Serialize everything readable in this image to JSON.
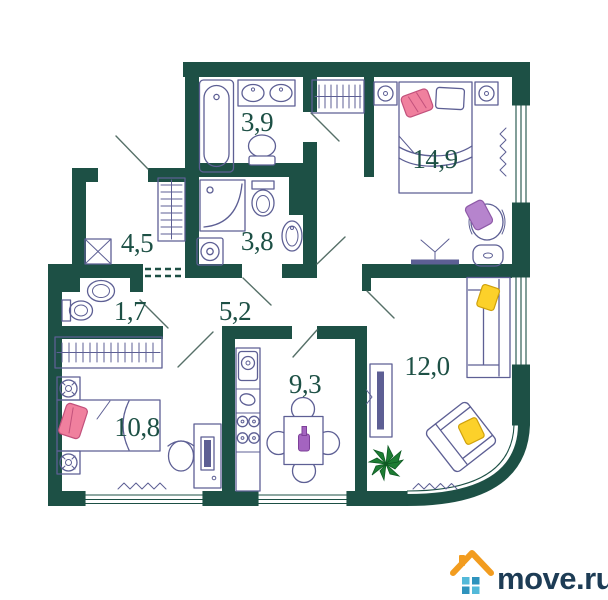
{
  "page": {
    "background": "#ffffff"
  },
  "floor_plan": {
    "rooms": [
      {
        "name": "bathroom-top",
        "area": "3,9"
      },
      {
        "name": "hallway",
        "area": "4,5"
      },
      {
        "name": "shower-bathroom",
        "area": "3,8"
      },
      {
        "name": "wc",
        "area": "1,7"
      },
      {
        "name": "corridor",
        "area": "5,2"
      },
      {
        "name": "bedroom",
        "area": "14,9"
      },
      {
        "name": "kids-room",
        "area": "10,8"
      },
      {
        "name": "kitchen",
        "area": "9,3"
      },
      {
        "name": "living-room",
        "area": "12,0"
      }
    ],
    "colors": {
      "wall": "#1d5045",
      "furniture_line": "#5d5f94",
      "pillow_pink": "#f0809e",
      "pillow_purple": "#b684cd",
      "pillow_yellow": "#fcd12a",
      "bottle_purple": "#a464c0",
      "plant_green": "#1d7c33"
    }
  },
  "logo": {
    "text": "move.ru",
    "house_orange": "#f29c1f",
    "window_blue": "#3fa9cf",
    "text_color": "#1d3c55"
  }
}
